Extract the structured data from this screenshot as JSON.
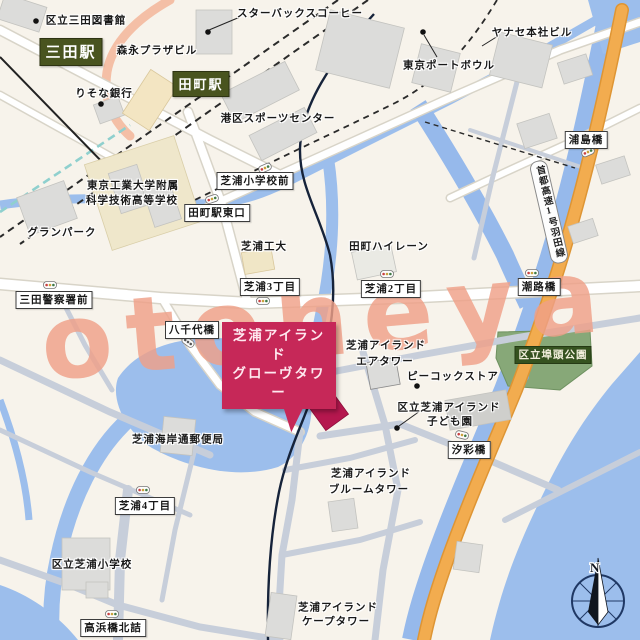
{
  "watermark": {
    "text": "otoheya",
    "color": "#EFA088"
  },
  "compass": {
    "north_label": "N"
  },
  "stations": {
    "mita": "三田駅",
    "tamachi": "田町駅"
  },
  "callout": {
    "line1": "芝浦アイランド",
    "line2": "グローヴタワー"
  },
  "highway": {
    "label": "首都高速1号羽田線"
  },
  "park": {
    "label": "区立埠頭公園"
  },
  "road_signs": {
    "urashima_bridge": "浦島橋",
    "shibaura_elem_front": "芝浦小学校前",
    "tamachi_east_exit": "田町駅東口",
    "mita_police_front": "三田警察署前",
    "shibaura_3chome": "芝浦3丁目",
    "shibaura_2chome": "芝浦2丁目",
    "shioji_bridge": "潮路橋",
    "yachiyo_bridge": "八千代橋",
    "shiosai_bridge": "汐彩橋",
    "shibaura_4chome": "芝浦4丁目",
    "takahama_bridge_north": "高浜橋北詰"
  },
  "pois": {
    "mita_library": "区立三田図書館",
    "morinaga_plaza": "森永プラザビル",
    "risona_bank": "りそな銀行",
    "starbucks": "スターバックスコーヒー",
    "yanase_hq": "ヤナセ本社ビル",
    "tokyo_port_bowl": "東京ポートボウル",
    "minato_sports_center": "港区スポーツセンター",
    "tech_high_line1": "東京工業大学附属",
    "tech_high_line2": "科学技術高等学校",
    "granpark": "グランパーク",
    "tamachi_highlane": "田町ハイレーン",
    "shibaura_kodai": "芝浦工大",
    "air_tower_line1": "芝浦アイランド",
    "air_tower_line2": "エアタワー",
    "peacock_store": "ピーコックストア",
    "kodomoen_line1": "区立芝浦アイランド",
    "kodomoen_line2": "子ども園",
    "post_office": "芝浦海岸通郵便局",
    "bloom_tower_line1": "芝浦アイランド",
    "bloom_tower_line2": "ブルームタワー",
    "shibaura_elementary": "区立芝浦小学校",
    "cape_tower_line1": "芝浦アイランド",
    "cape_tower_line2": "ケープタワー"
  },
  "colors": {
    "water": "#9CBEEC",
    "highway_orange": "#F2AC4F",
    "station_box_green": "#49541F",
    "park_label_green": "#35521F",
    "park_area_green": "#87A878",
    "callout_magenta": "#C62858",
    "highlight_building": "#B5174E",
    "watermark_salmon": "#EFA088",
    "building_gray": "#DCDCDA",
    "rail_dash_black": "#2A2A2A",
    "monorail_navy": "#16233A",
    "subway_teal": "#8FD0CE"
  }
}
